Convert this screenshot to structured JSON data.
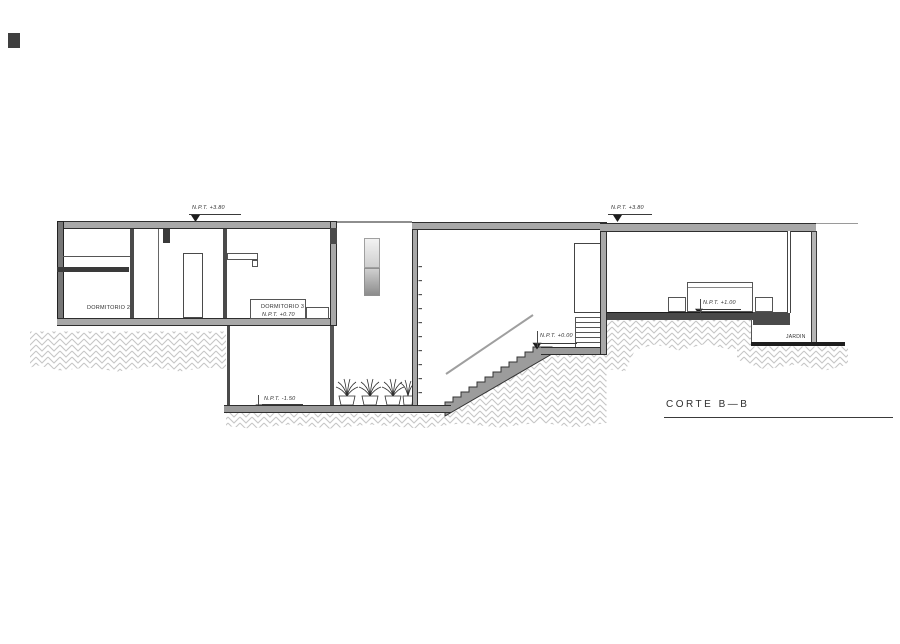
{
  "title": {
    "section_label": "CORTE B—B"
  },
  "levels": {
    "roof_left": "N.P.T.  +3.80",
    "roof_right": "N.P.T.  +3.80",
    "dorm3": "N.P.T.  +0.70",
    "basement": "N.P.T.  -1.50",
    "entry": "N.P.T.  +0.00",
    "bedroom": "N.P.T.  +1.00"
  },
  "rooms": {
    "dorm2": "DORMITORIO 2",
    "dorm3": "DORMITORIO 3",
    "garden": "JARDIN"
  },
  "colors": {
    "wall_fill": "#a8a8a8",
    "dark_line": "#2e2e2e",
    "hatch_line": "#c6c6c6",
    "floor_dark": "#4a4a4a"
  }
}
